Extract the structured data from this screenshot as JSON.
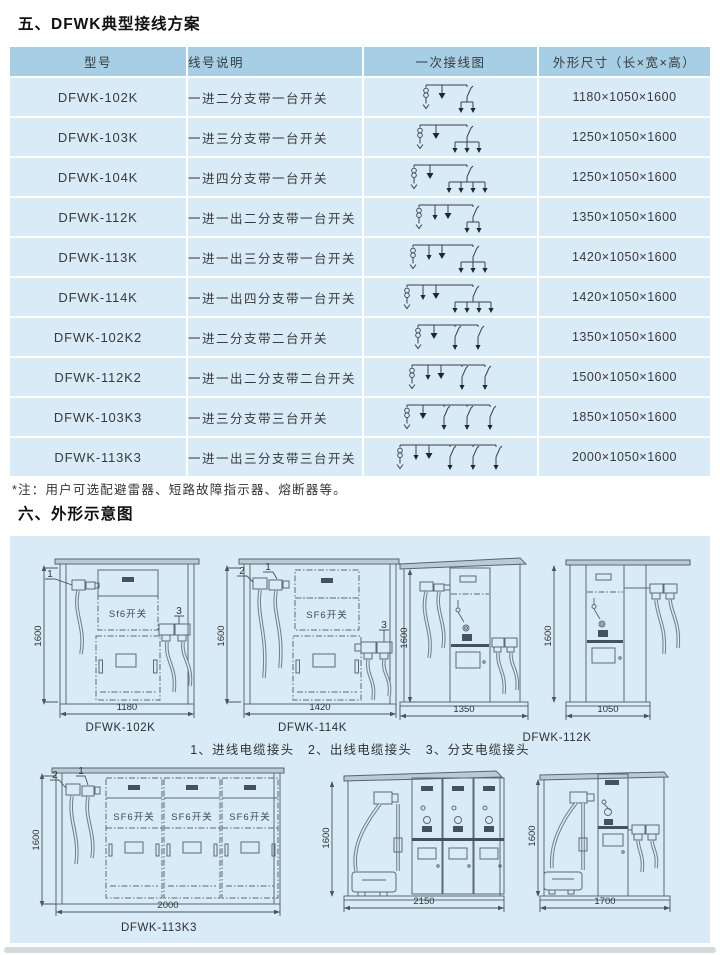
{
  "page": {
    "section5_title": "五、DFWK典型接线方案",
    "note": "*注：用户可选配避雷器、短路故障指示器、熔断器等。",
    "section6_title": "六、外形示意图",
    "colors": {
      "header_bg": "#a6cfe5",
      "row_bg": "#d9ebf7",
      "panel_bg": "#d9ebf7"
    }
  },
  "table": {
    "headers": [
      {
        "label": "型号"
      },
      {
        "label": "线号说明"
      },
      {
        "label": "一次接线图"
      },
      {
        "label": "外形尺寸（长×宽×高）"
      }
    ],
    "rows": [
      {
        "model": "DFWK-102K",
        "desc": "一进二分支带一台开关",
        "dim": "1180×1050×1600",
        "diagram": {
          "out": 0,
          "groups": [
            2
          ]
        }
      },
      {
        "model": "DFWK-103K",
        "desc": "一进三分支带一台开关",
        "dim": "1250×1050×1600",
        "diagram": {
          "out": 0,
          "groups": [
            3
          ]
        }
      },
      {
        "model": "DFWK-104K",
        "desc": "一进四分支带一台开关",
        "dim": "1250×1050×1600",
        "diagram": {
          "out": 0,
          "groups": [
            4
          ]
        }
      },
      {
        "model": "DFWK-112K",
        "desc": "一进一出二分支带一台开关",
        "dim": "1350×1050×1600",
        "diagram": {
          "out": 1,
          "groups": [
            2
          ]
        }
      },
      {
        "model": "DFWK-113K",
        "desc": "一进一出三分支带一台开关",
        "dim": "1420×1050×1600",
        "diagram": {
          "out": 1,
          "groups": [
            3
          ]
        }
      },
      {
        "model": "DFWK-114K",
        "desc": "一进一出四分支带一台开关",
        "dim": "1420×1050×1600",
        "diagram": {
          "out": 1,
          "groups": [
            4
          ]
        }
      },
      {
        "model": "DFWK-102K2",
        "desc": "一进二分支带二台开关",
        "dim": "1350×1050×1600",
        "diagram": {
          "out": 0,
          "groups": [
            1,
            1
          ]
        }
      },
      {
        "model": "DFWK-112K2",
        "desc": "一进一出二分支带二台开关",
        "dim": "1500×1050×1600",
        "diagram": {
          "out": 1,
          "groups": [
            1,
            1
          ]
        }
      },
      {
        "model": "DFWK-103K3",
        "desc": "一进三分支带三台开关",
        "dim": "1850×1050×1600",
        "diagram": {
          "out": 0,
          "groups": [
            1,
            1,
            1
          ]
        }
      },
      {
        "model": "DFWK-113K3",
        "desc": "一进一出三分支带三台开关",
        "dim": "2000×1050×1600",
        "diagram": {
          "out": 1,
          "groups": [
            1,
            1,
            1
          ]
        }
      }
    ]
  },
  "outline": {
    "caption": "1、进线电缆接头　2、出线电缆接头　3、分支电缆接头",
    "drawings": [
      {
        "model": "DFWK-102K",
        "height_dim": "1600",
        "width_dim": "1180",
        "unit_label": "Sf6开关",
        "callouts": [
          "1",
          "3"
        ]
      },
      {
        "model": "DFWK-114K",
        "height_dim": "1600",
        "width_dim": "1420",
        "unit_label": "SF6开关",
        "callouts": [
          "2",
          "1",
          "3"
        ]
      },
      {
        "model": "",
        "height_dim": "1600",
        "width_dim": "1350",
        "unit_label": "",
        "callouts": []
      },
      {
        "model": "DFWK-112K",
        "height_dim": "1600",
        "width_dim": "1050",
        "unit_label": "",
        "callouts": []
      },
      {
        "model": "DFWK-113K3",
        "height_dim": "1600",
        "width_dim": "2000",
        "unit_label": "SF6开关",
        "callouts": [
          "2",
          "1"
        ]
      },
      {
        "model": "",
        "height_dim": "1600",
        "width_dim": "2150",
        "unit_label": "",
        "callouts": []
      },
      {
        "model": "",
        "height_dim": "1600",
        "width_dim": "1700",
        "unit_label": "",
        "callouts": []
      }
    ]
  }
}
